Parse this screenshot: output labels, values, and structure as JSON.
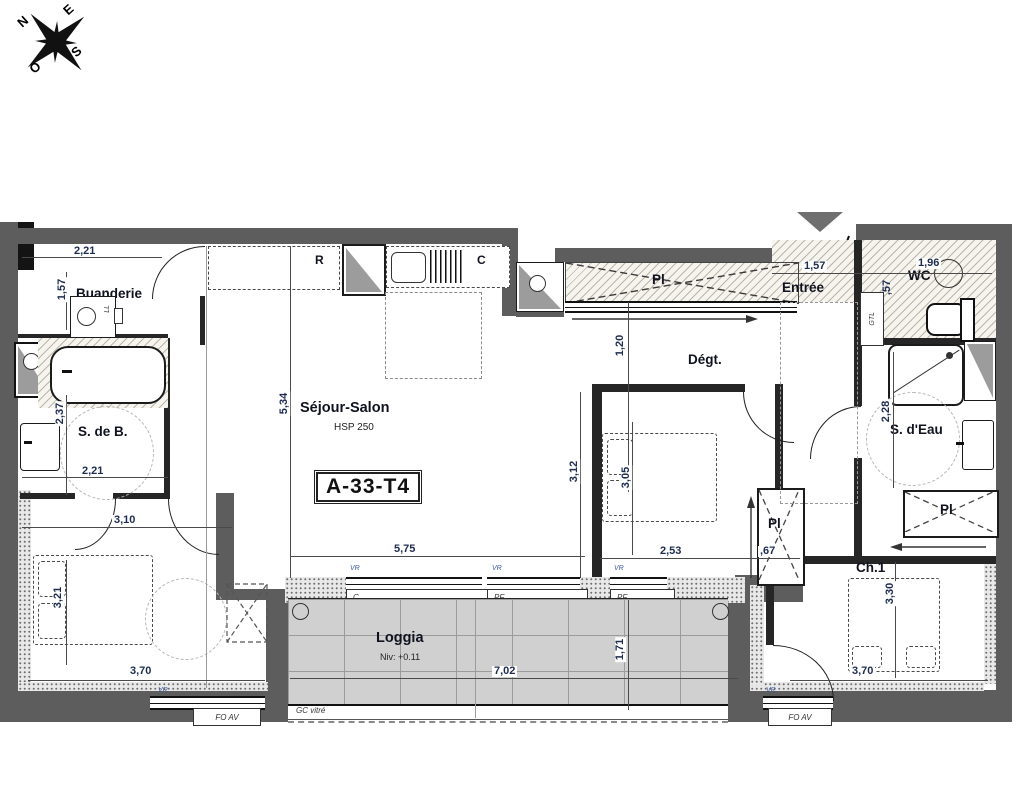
{
  "compass": {
    "n": "N",
    "e": "E",
    "s": "S",
    "o": "O"
  },
  "unit": {
    "label": "A-33-T4"
  },
  "rooms": {
    "buanderie": {
      "name": "Buanderie"
    },
    "sdb": {
      "name": "S. de B."
    },
    "sejour": {
      "name": "Séjour-Salon",
      "hsp": "HSP 250"
    },
    "ch3": {
      "name": "Ch.3"
    },
    "ch2": {
      "name": "Ch.2"
    },
    "ch1": {
      "name": "Ch.1"
    },
    "entree": {
      "name": "Entrée"
    },
    "degagement": {
      "name": "Dégt."
    },
    "wc": {
      "name": "WC"
    },
    "sdeau": {
      "name": "S. d'Eau"
    },
    "loggia": {
      "name": "Loggia",
      "level": "Niv: +0.11"
    },
    "placard": {
      "name": "Pl"
    }
  },
  "dims": {
    "buanderie_w": "2,21",
    "buanderie_h": "1,57",
    "sdb_h": "2,37",
    "sdb_w": "2,21",
    "hall_w": "3,10",
    "sejour_h": "5,34",
    "sejour_w": "5,75",
    "ch2_h": "3,12",
    "ch2_bed_h": "3,05",
    "ch2_w": "2,53",
    "pl_ch2_w": ",67",
    "degt_w": "1,20",
    "entree_w": "1,57",
    "wc_w": "1,96",
    "gtl_w": ",57",
    "sdeau_h": "2,28",
    "ch1_h": "3,30",
    "ch1_w": "3,70",
    "ch3_h": "3,21",
    "ch3_w": "3,70",
    "loggia_w": "7,02",
    "loggia_h": "1,71"
  },
  "labels": {
    "gtl": "GTL",
    "ll": "LL",
    "kitchen_fridge": "R",
    "kitchen_c": "C",
    "window_c": "C",
    "window_pf": "PF",
    "vr": "VR",
    "foav": "FO AV",
    "gc_vitre": "GC vitré",
    "pl": "Pl"
  },
  "colors": {
    "wall": "#5d5d5d",
    "dim_text": "#1d2c4f",
    "loggia_tile": "#d0d0d0",
    "hatch": "#8e846e"
  }
}
